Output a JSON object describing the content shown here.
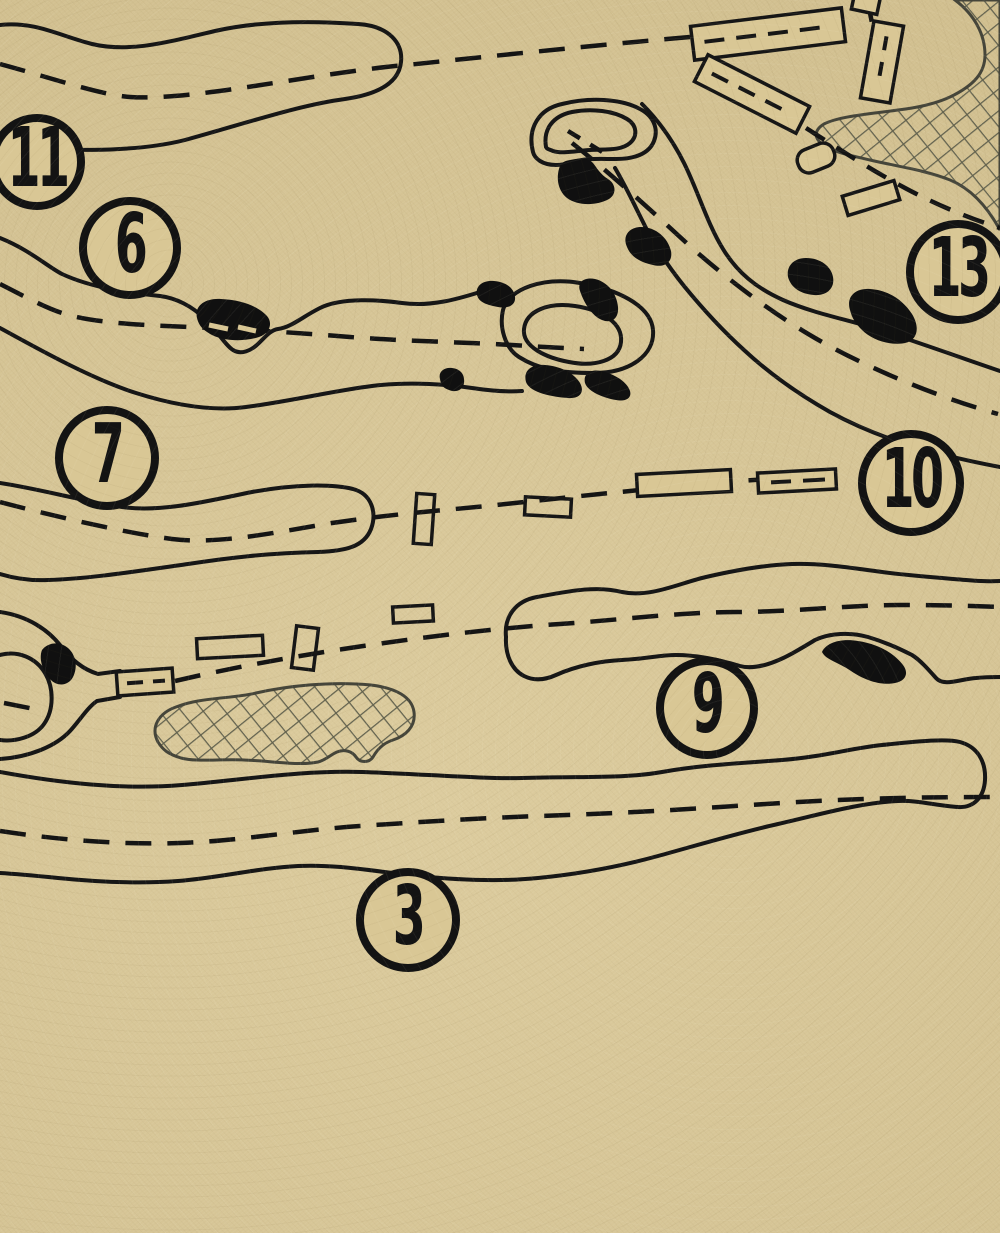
{
  "app": {
    "type": "golf-course-routing-map",
    "description": "Blueprint-style golf course outline map on kraft paper"
  },
  "palette": {
    "paper": "#d8c695",
    "ink": "#161616",
    "bunker_fill": "#101010",
    "hazard_outline": "#45453a",
    "hazard_hatch": "#61614e"
  },
  "hole_markers": [
    {
      "label": "11",
      "cx": 37,
      "cy": 162,
      "d": 96
    },
    {
      "label": "6",
      "cx": 130,
      "cy": 248,
      "d": 102
    },
    {
      "label": "7",
      "cx": 107,
      "cy": 458,
      "d": 104
    },
    {
      "label": "13",
      "cx": 958,
      "cy": 272,
      "d": 104
    },
    {
      "label": "10",
      "cx": 911,
      "cy": 483,
      "d": 106
    },
    {
      "label": "9",
      "cx": 707,
      "cy": 708,
      "d": 102
    },
    {
      "label": "3",
      "cx": 408,
      "cy": 920,
      "d": 104
    }
  ]
}
